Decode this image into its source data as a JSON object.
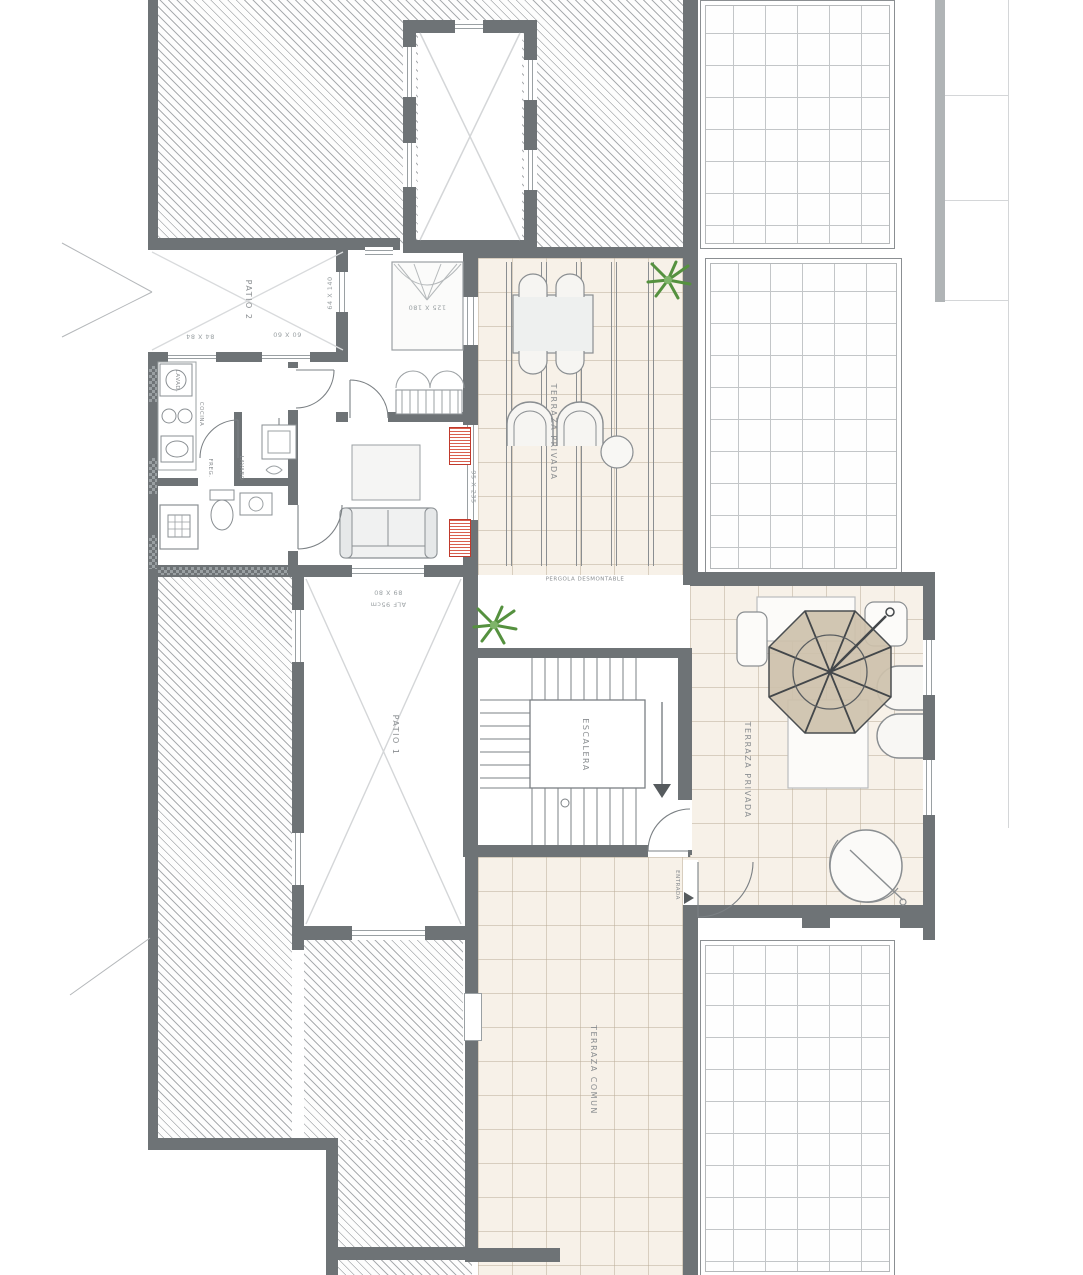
{
  "plan": {
    "title": "Floor plan - roof / terrace level",
    "labels": {
      "patio1": "PATIO 1",
      "patio2": "PATIO 2",
      "escalera": "ESCALERA",
      "terraza_privada_top": "TERRAZA PRIVADA",
      "terraza_privada_right": "TERRAZA PRIVADA",
      "terraza_comun": "TERRAZA COMUN",
      "pergola": "PERGOLA DESMONTABLE",
      "entrada": "ENTRADA"
    },
    "kitchen": {
      "lavadora": "LAVAD.",
      "cocina": "COCINA",
      "fregadero": "FREG.",
      "lavabo": "LAVABO"
    },
    "dims": {
      "bed": "125 X 180",
      "patio2_left": "84 X 84",
      "patio2_right": "60 X 60",
      "patio2_side": "64 X 140",
      "patio1_line1": "89 X 80",
      "patio1_line2": "ALF 95cm",
      "living_window": "95 X 235"
    },
    "colors": {
      "wall": "#6e7376",
      "tile_beige": "#f7f1e8",
      "umbrella": "#cdc1ab",
      "plant": "#55913f",
      "accent_red": "#c0392b"
    }
  }
}
